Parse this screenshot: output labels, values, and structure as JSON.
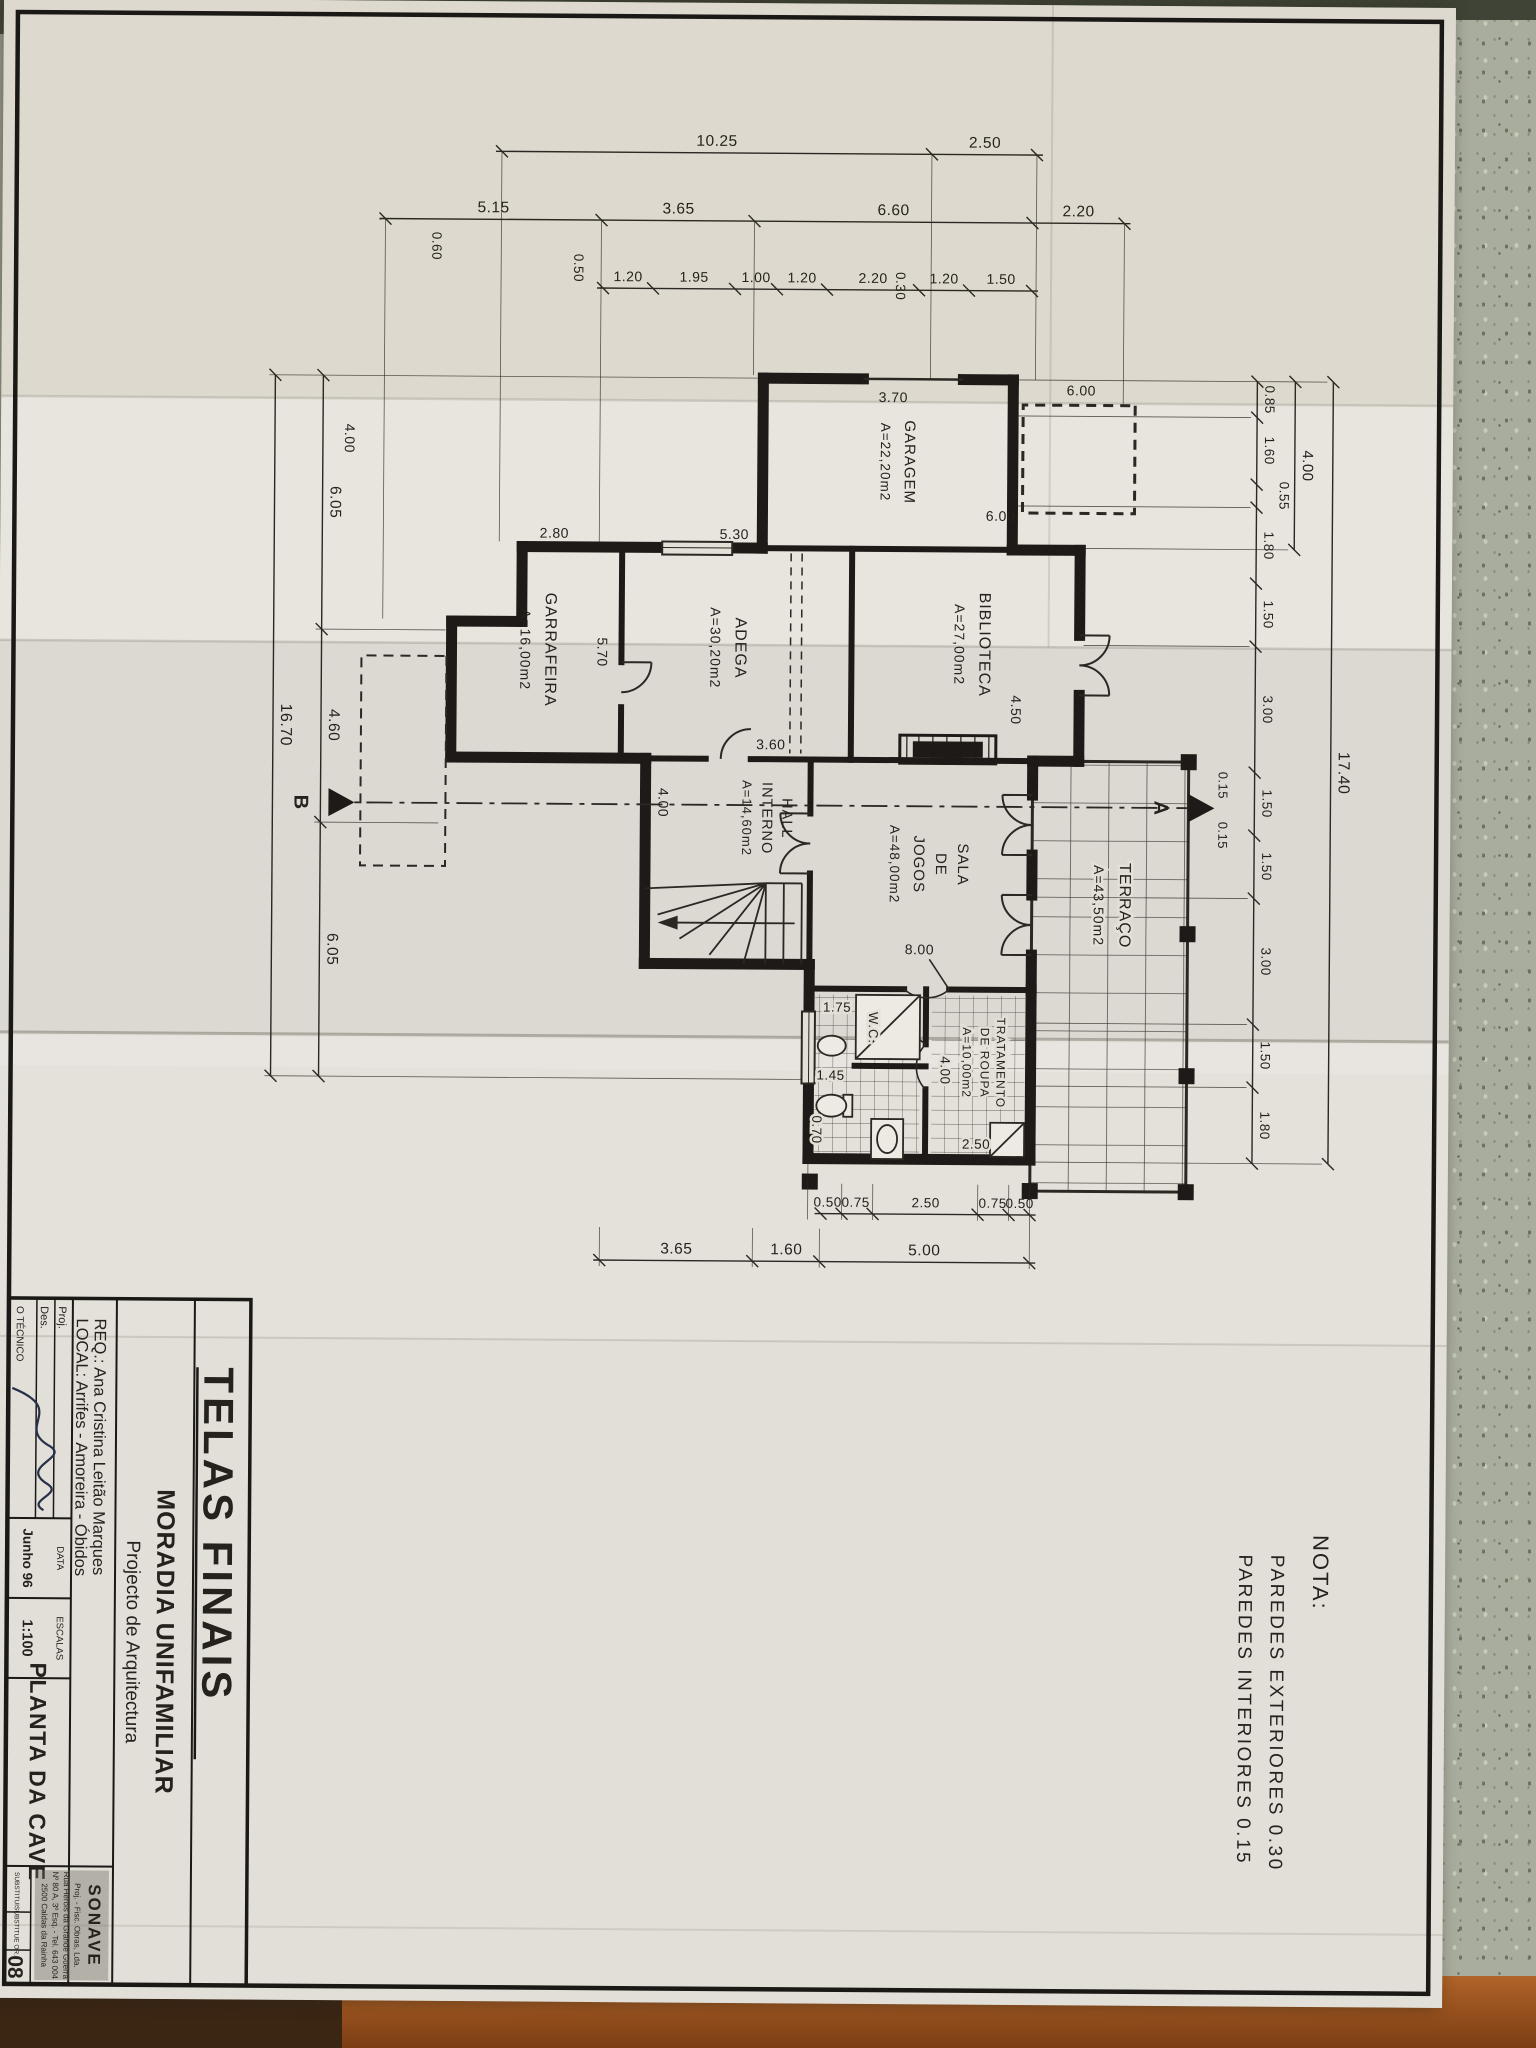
{
  "scene": {
    "floor_color": "#8a4a1f",
    "backing": "terrazzo"
  },
  "sheet": {
    "paper_color": "#e0ddd5",
    "ink_color": "#2b2722",
    "note": {
      "title": "NOTA:",
      "line1": "PAREDES  EXTERIORES  0.30",
      "line2": "PAREDES  INTERIORES  0.15"
    },
    "section_marks": {
      "a": "A",
      "b": "B"
    }
  },
  "plan": {
    "rooms": {
      "garagem": {
        "name": "GARAGEM",
        "area": "A=22,20m2"
      },
      "biblioteca": {
        "name": "BIBLIOTECA",
        "area": "A=27,00m2"
      },
      "adega": {
        "name": "ADEGA",
        "area": "A=30,20m2"
      },
      "garrafeira": {
        "name": "GARRAFEIRA",
        "area": "A=16,00m2"
      },
      "hall": {
        "line1": "HALL",
        "line2": "INTERNO",
        "area": "A=14,60m2"
      },
      "sala": {
        "line1": "SALA",
        "line2": "DE",
        "line3": "JOGOS",
        "area": "A=48,00m2"
      },
      "terraco": {
        "name": "TERRAÇO",
        "area": "A=43,50m2"
      },
      "tratamento": {
        "line1": "TRATAMENTO",
        "line2": "DE ROUPA",
        "area": "A=10,00m2"
      },
      "wc": {
        "name": "W.C."
      }
    },
    "dims": {
      "left_outer": [
        "2.50",
        "10.25"
      ],
      "left_mid": [
        "2.20",
        "6.60",
        "3.65",
        "5.15"
      ],
      "left_inner": [
        "1.50",
        "1.20",
        "2.20",
        "1.20",
        "1.00",
        "1.95",
        "1.20"
      ],
      "left_extra": [
        "0.50",
        "0.60",
        "0.30"
      ],
      "top_total": "17.40",
      "top_mid": [
        "4.00",
        "0.15",
        "0.15"
      ],
      "top_inner": [
        "0.85",
        "1.60",
        "0.55",
        "1.80",
        "1.50",
        "3.00",
        "1.50",
        "1.50",
        "3.00",
        "1.50",
        "1.80"
      ],
      "right_inner": [
        "0.50",
        "0.75",
        "2.50",
        "0.75",
        "0.50"
      ],
      "right_outer": [
        "5.00",
        "1.60",
        "3.65"
      ],
      "bottom_inner": [
        "6.05",
        "4.60",
        "6.05"
      ],
      "bottom_total": "16.70",
      "bottom_extra": "4.00",
      "inplan": [
        "3.70",
        "6.00",
        "6.00",
        "4.50",
        "8.00",
        "3.60",
        "4.00",
        "5.70",
        "5.30",
        "2.80",
        "2.50",
        "4.00",
        "1.75",
        "1.45",
        "0.70"
      ]
    }
  },
  "titleblock": {
    "header": "TELAS FINAIS",
    "project": "MORADIA UNIFAMILIAR",
    "subtitle": "Projecto de Arquitectura",
    "req": "REQ.:  Ana Cristina Leitão Marques",
    "local": "LOCAL:  Arrifes - Amoreira - Óbidos",
    "drawing_title": "PLANTA DA CAVE",
    "proj_label": "Proj.",
    "des_label": "Des.",
    "tecnico_label": "O TÉCNICO",
    "data_label": "DATA",
    "data_value": "Junho 96",
    "escalas_label": "ESCALAS",
    "escala_value": "1:100",
    "substitui_label": "SUBSTITUI",
    "substituido_label": "SUBSTITUE OR.",
    "sheet_number": "08",
    "stamp": {
      "name": "SONAVE",
      "line1": "Proj. - Fisc. Obras, Lda.",
      "line2": "Rua Heróis da Grande Guerra",
      "line3": "Nº 80 A, 3º Esq. - Tel. 643 004",
      "line4": "2500 Caldas da Rainha"
    }
  }
}
